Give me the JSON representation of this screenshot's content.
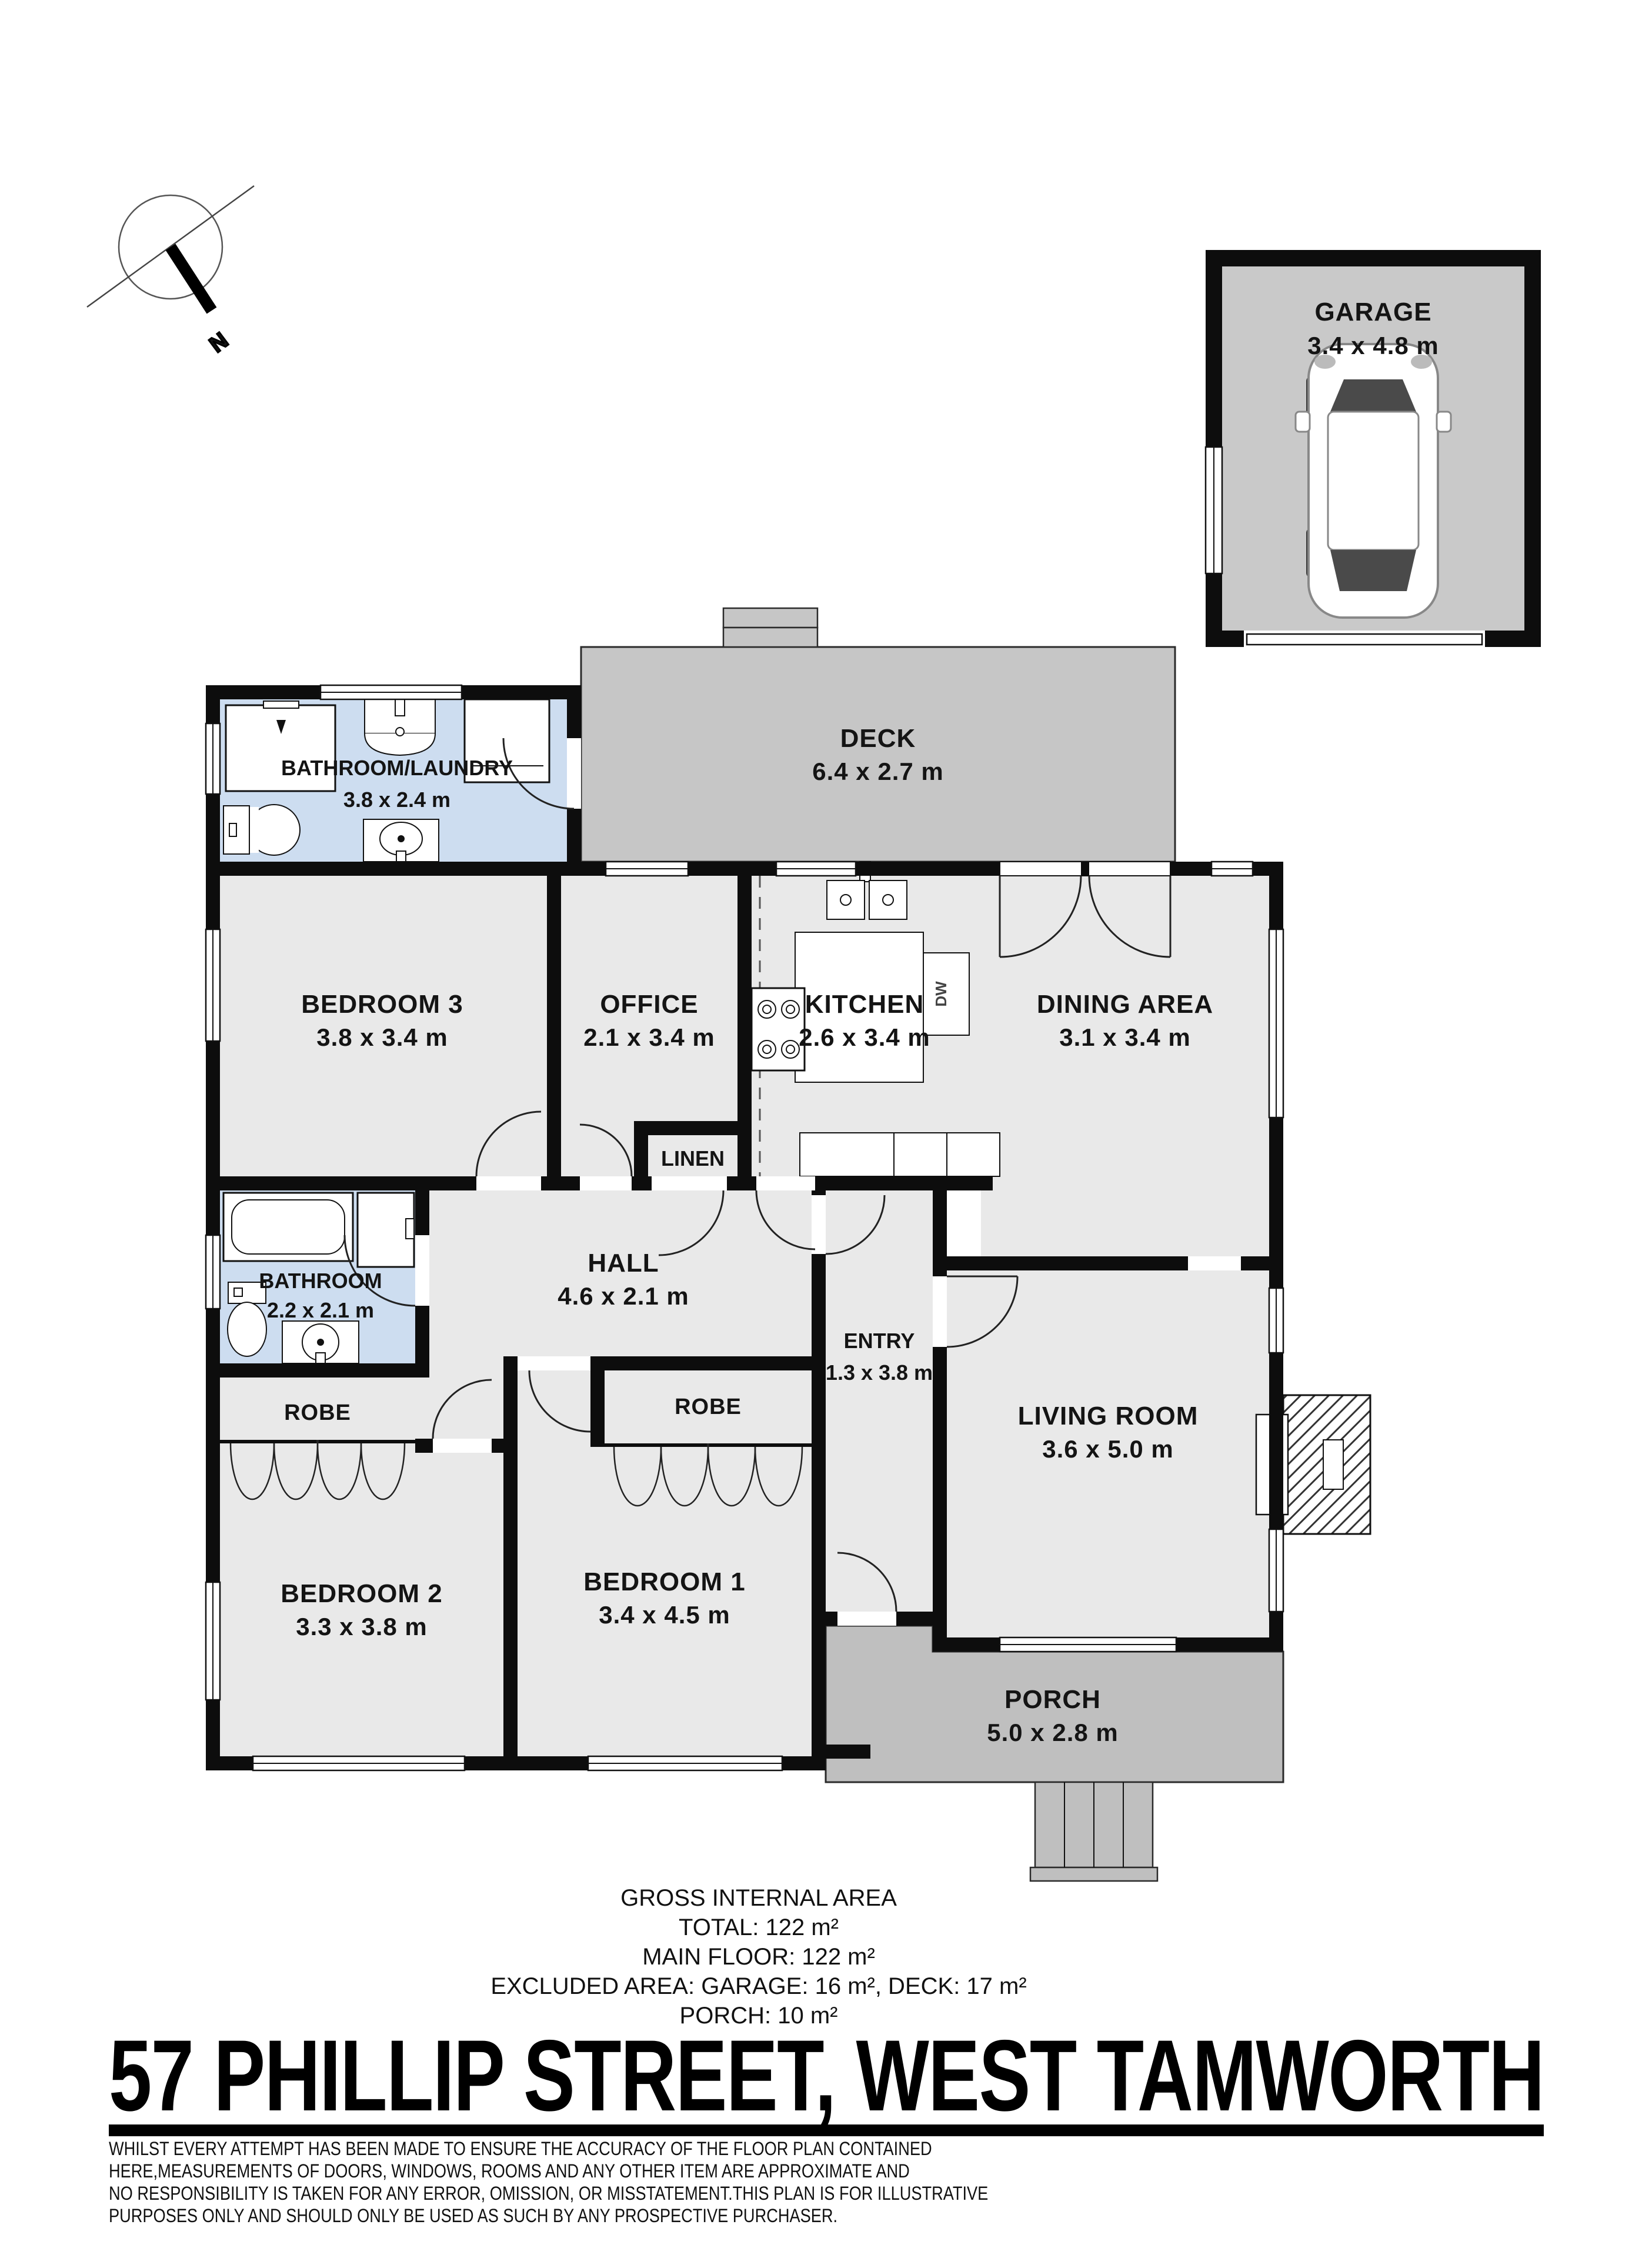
{
  "title": "57 PHILLIP STREET, WEST TAMWORTH",
  "compass": {
    "north_label": "N"
  },
  "rooms": {
    "garage": {
      "name": "GARAGE",
      "dims": "3.4 x 4.8 m"
    },
    "deck": {
      "name": "DECK",
      "dims": "6.4 x 2.7 m"
    },
    "bathroom_laundry": {
      "name": "BATHROOM/LAUNDRY",
      "dims": "3.8 x 2.4 m"
    },
    "bedroom3": {
      "name": "BEDROOM 3",
      "dims": "3.8 x 3.4 m"
    },
    "office": {
      "name": "OFFICE",
      "dims": "2.1 x 3.4 m"
    },
    "kitchen": {
      "name": "KITCHEN",
      "dims": "2.6 x 3.4 m"
    },
    "dining": {
      "name": "DINING AREA",
      "dims": "3.1 x 3.4 m"
    },
    "linen": {
      "name": "LINEN"
    },
    "hall": {
      "name": "HALL",
      "dims": "4.6 x 2.1 m"
    },
    "bathroom": {
      "name": "BATHROOM",
      "dims": "2.2 x 2.1 m"
    },
    "robe_bedroom2": {
      "name": "ROBE"
    },
    "robe_bedroom1": {
      "name": "ROBE"
    },
    "entry": {
      "name": "ENTRY",
      "dims": "1.3 x 3.8 m"
    },
    "living": {
      "name": "LIVING ROOM",
      "dims": "3.6 x 5.0 m"
    },
    "bedroom1": {
      "name": "BEDROOM 1",
      "dims": "3.4 x 4.5 m"
    },
    "bedroom2": {
      "name": "BEDROOM 2",
      "dims": "3.3 x 3.8 m"
    },
    "porch": {
      "name": "PORCH",
      "dims": "5.0 x 2.8 m"
    }
  },
  "kitchen_appliances": {
    "dishwasher_label": "DW"
  },
  "area_summary": {
    "heading": "GROSS INTERNAL AREA",
    "total": "TOTAL: 122 m²",
    "main_floor": "MAIN FLOOR: 122 m²",
    "excluded": "EXCLUDED AREA: GARAGE: 16 m², DECK: 17 m²",
    "porch": "PORCH: 10 m²"
  },
  "disclaimer": {
    "line1": "WHILST EVERY ATTEMPT HAS BEEN MADE TO ENSURE THE ACCURACY OF THE FLOOR PLAN CONTAINED",
    "line2": "HERE,MEASUREMENTS OF DOORS, WINDOWS, ROOMS AND ANY OTHER ITEM ARE APPROXIMATE AND",
    "line3": "NO RESPONSIBILITY IS TAKEN FOR ANY ERROR, OMISSION, OR MISSTATEMENT.THIS PLAN IS FOR ILLUSTRATIVE",
    "line4": "PURPOSES ONLY AND SHOULD ONLY BE USED AS SUCH BY ANY PROSPECTIVE PURCHASER."
  },
  "colors": {
    "wall": "#0d0d0d",
    "room_fill": "#e9e9e9",
    "wet_room_fill": "#cdddf0",
    "deck_fill": "#c6c6c6",
    "porch_fill": "#bfbfbf",
    "garage_floor_fill": "#c9c9c9",
    "label_text": "#141414"
  }
}
